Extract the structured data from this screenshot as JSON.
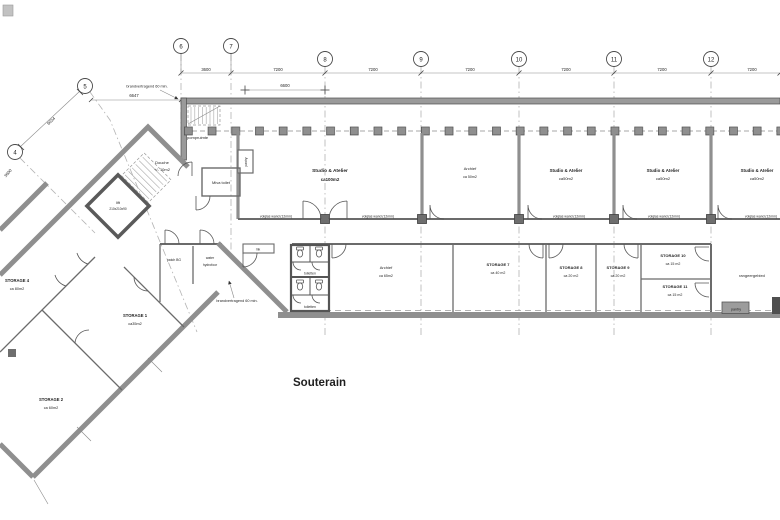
{
  "title": "Souterain",
  "grid": {
    "bubbles": [
      "4",
      "5",
      "6",
      "7",
      "8",
      "9",
      "10",
      "11",
      "12"
    ],
    "top_dims": [
      "3600",
      "7200",
      "7200",
      "7200",
      "7200",
      "7200",
      "7200"
    ],
    "sub_dim": "6600",
    "dim_6647": "6647",
    "dim_6034": "6034",
    "dim_3600_left": "3600"
  },
  "annotations": {
    "fire": "brandvertragend 60 min.",
    "glass": "volglas wand (12mm)",
    "patch": "patch BG",
    "water_1": "water",
    "water_2": "hydrofoor",
    "mk": "mk",
    "rangeer": "rangeergebied",
    "pantry_box": "pantry",
    "pantry_niche": "pantry",
    "toiletten": "toiletten"
  },
  "rooms": {
    "pompruimte": {
      "name": "pompruimte"
    },
    "douche": {
      "name": "Douche",
      "area": "+/- 10m2"
    },
    "lift": {
      "name": "lift",
      "size": "210x210x90"
    },
    "miva": {
      "name": "Miva toilet"
    },
    "studio_100": {
      "name": "Studio & Atelier",
      "area": "ca100m2"
    },
    "archief_50": {
      "name": "Archief",
      "area": "ca 50m2"
    },
    "studio_50": {
      "name": "Studio & Atelier",
      "area": "ca50m2"
    },
    "archief_65": {
      "name": "Archief",
      "area": "ca 65m2"
    },
    "storage7": {
      "name": "STORAGE 7",
      "area": "ca 40 m2"
    },
    "storage8": {
      "name": "STORAGE 8",
      "area": "ca 20 m2"
    },
    "storage9": {
      "name": "STORAGE 9",
      "area": "ca 20 m2"
    },
    "storage10": {
      "name": "STORAGE 10",
      "area": "ca 15 m2"
    },
    "storage11": {
      "name": "STORAGE 11",
      "area": "ca 15 m2"
    },
    "storage4": {
      "name": "STORAGE 4",
      "area": "ca 80m2"
    },
    "storage1": {
      "name": "STORAGE 1",
      "area": "ca35m2"
    },
    "storage2": {
      "name": "STORAGE 2",
      "area": "ca 60m2"
    }
  }
}
